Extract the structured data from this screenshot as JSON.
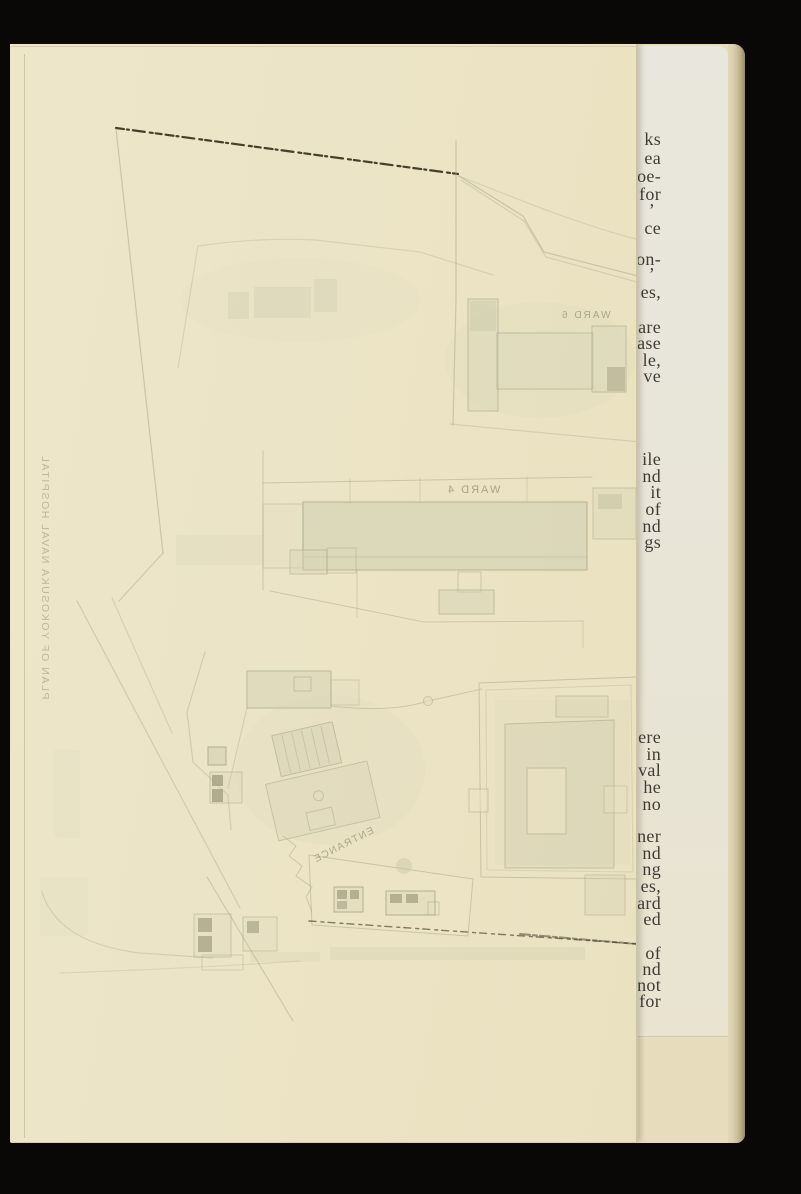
{
  "scene": {
    "description": "Scanned book page: folded map plate of a naval hospital lying over a printed text page",
    "background_color": "#0a0806",
    "map_sheet_color": "#ece4c6",
    "text_page_color": "#e8e6da",
    "page_edge_color": "#d6cbaa"
  },
  "map": {
    "side_caption": "PLAN OF YOKOSUKA NAVAL HOSPITAL",
    "labels": {
      "ward6": "WARD 6",
      "ward4": "WARD 4",
      "entrance": "ENTRANCE"
    },
    "line_color": "#a9a68a",
    "building_fill": "#d5d2b5",
    "dark_hatch_color": "#8e8b6d",
    "boundary_dash_color": "#332e1a"
  },
  "text_column": {
    "font_color": "#3e3d35",
    "fragments": [
      {
        "text": "ks",
        "top": 130
      },
      {
        "text": "ea",
        "top": 149
      },
      {
        "text": "oe-",
        "top": 167
      },
      {
        "text": "for",
        "top": 185
      },
      {
        "text": "’",
        "top": 201,
        "right": 146
      },
      {
        "text": "ce",
        "top": 219
      },
      {
        "text": "on-",
        "top": 250
      },
      {
        "text": "’",
        "top": 265,
        "right": 146
      },
      {
        "text": "es,",
        "top": 283
      },
      {
        "text": "are",
        "top": 318
      },
      {
        "text": "ase",
        "top": 334
      },
      {
        "text": "le,",
        "top": 351
      },
      {
        "text": "ve",
        "top": 367
      },
      {
        "text": "ile",
        "top": 450
      },
      {
        "text": "nd",
        "top": 467
      },
      {
        "text": "it",
        "top": 483
      },
      {
        "text": "of",
        "top": 500
      },
      {
        "text": "nd",
        "top": 517
      },
      {
        "text": "gs",
        "top": 533
      },
      {
        "text": "ere",
        "top": 728
      },
      {
        "text": "in",
        "top": 745
      },
      {
        "text": "val",
        "top": 761
      },
      {
        "text": "he",
        "top": 778
      },
      {
        "text": "no",
        "top": 795
      },
      {
        "text": "ner",
        "top": 827
      },
      {
        "text": "nd",
        "top": 844
      },
      {
        "text": "ng",
        "top": 860
      },
      {
        "text": "es,",
        "top": 877
      },
      {
        "text": "ard",
        "top": 894
      },
      {
        "text": "ed",
        "top": 910
      },
      {
        "text": "of",
        "top": 944
      },
      {
        "text": "nd",
        "top": 960
      },
      {
        "text": "not",
        "top": 976
      },
      {
        "text": "for",
        "top": 992
      }
    ]
  }
}
